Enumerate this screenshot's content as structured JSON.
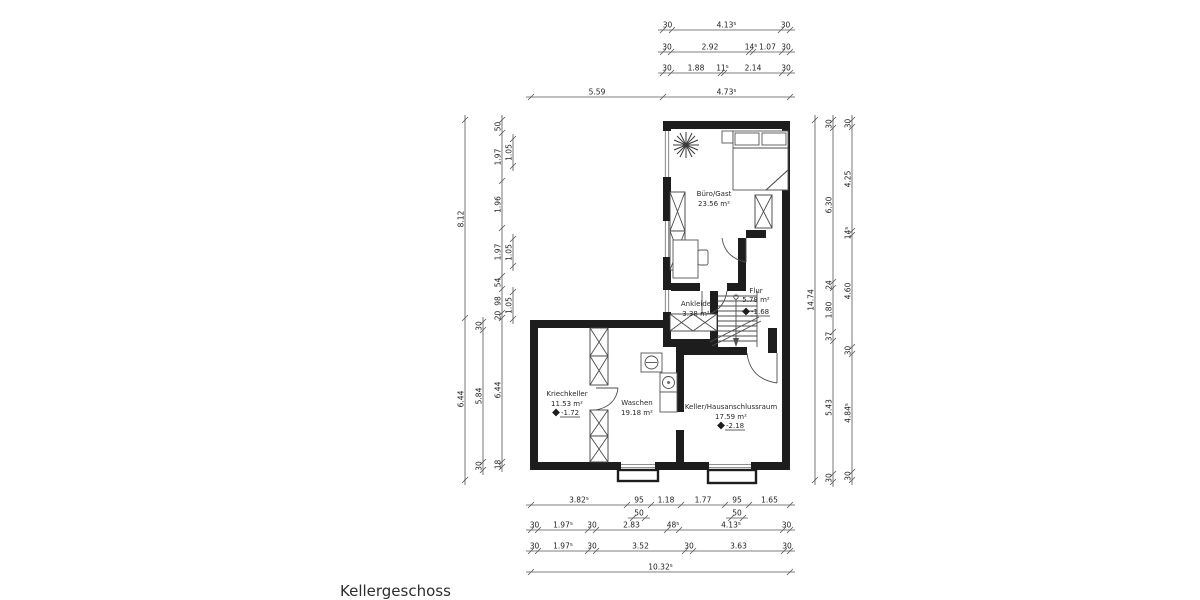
{
  "title": "Kellergeschoss",
  "rooms": {
    "buero": {
      "name": "Büro/Gast",
      "area": "23.56 m²"
    },
    "ankleide": {
      "name": "Ankleide",
      "area": "3.38 m²"
    },
    "flur": {
      "name": "Flur",
      "area": "5.78 m²",
      "level": "-1.68"
    },
    "kriechkeller": {
      "name": "Kriechkeller",
      "area": "11.53 m²",
      "level": "-1.72"
    },
    "waschen": {
      "name": "Waschen",
      "area": "19.18 m²"
    },
    "keller": {
      "name": "Keller/Hausanschlussraum",
      "area": "17.59 m²",
      "level": "-2.18"
    }
  },
  "colors": {
    "wall": "#1d1d1d",
    "dim_line": "#555555",
    "dim_text": "#222222"
  },
  "dim_chains": [
    {
      "id": "top-1",
      "orient": "h",
      "pos": 30,
      "ticks": [
        663,
        672,
        781,
        790
      ],
      "labels": [
        "30",
        "4.13⁵",
        "30"
      ]
    },
    {
      "id": "top-2",
      "orient": "h",
      "pos": 52,
      "ticks": [
        663,
        671,
        749,
        753,
        782,
        790
      ],
      "labels": [
        "30",
        "2.92",
        "14⁵",
        "1.07",
        "30"
      ]
    },
    {
      "id": "top-3",
      "orient": "h",
      "pos": 73,
      "ticks": [
        663,
        671,
        721,
        724,
        782,
        790
      ],
      "labels": [
        "30",
        "1.88",
        "11⁵",
        "2.14",
        "30"
      ]
    },
    {
      "id": "top-4",
      "orient": "h",
      "pos": 97,
      "ticks": [
        531,
        663,
        790
      ],
      "labels": [
        "5.59",
        "4.73⁵"
      ]
    },
    {
      "id": "left-1",
      "orient": "v",
      "pos": 465,
      "ticks": [
        120,
        318,
        480
      ],
      "labels": [
        "8.12",
        "6.44"
      ]
    },
    {
      "id": "left-2",
      "orient": "v",
      "pos": 483,
      "ticks": [
        322,
        330,
        462,
        470
      ],
      "labels": [
        "30",
        "5.84",
        "30"
      ]
    },
    {
      "id": "left-3",
      "orient": "v",
      "pos": 502,
      "ticks": [
        120,
        133,
        181,
        228,
        276,
        289,
        313,
        318,
        462,
        467
      ],
      "labels": [
        "50",
        "1.97",
        "1.96",
        "1.97",
        "54",
        "98",
        "20",
        "6.44",
        "18"
      ]
    },
    {
      "id": "left-3b",
      "orient": "v",
      "pos": 513,
      "ticks": [
        139,
        166
      ],
      "labels": [
        "1.05"
      ]
    },
    {
      "id": "left-3c",
      "orient": "v",
      "pos": 513,
      "ticks": [
        239,
        266
      ],
      "labels": [
        "1.05"
      ]
    },
    {
      "id": "left-3d",
      "orient": "v",
      "pos": 513,
      "ticks": [
        292,
        319
      ],
      "labels": [
        "1.05"
      ]
    },
    {
      "id": "right-1",
      "orient": "v",
      "pos": 815,
      "ticks": [
        120,
        480
      ],
      "labels": [
        "14.74"
      ]
    },
    {
      "id": "right-2",
      "orient": "v",
      "pos": 833,
      "ticks": [
        120,
        128,
        282,
        288,
        332,
        341,
        474,
        482
      ],
      "labels": [
        "30",
        "6.30",
        "24",
        "1.80",
        "37",
        "5.43",
        "30"
      ]
    },
    {
      "id": "right-3",
      "orient": "v",
      "pos": 852,
      "ticks": [
        120,
        127,
        231,
        235,
        347,
        354,
        472,
        480
      ],
      "labels": [
        "30",
        "4.25",
        "14⁵",
        "4.60",
        "30",
        "4.84⁵",
        "30"
      ]
    },
    {
      "id": "bot-1",
      "orient": "h",
      "pos": 505,
      "ticks": [
        531,
        627,
        651,
        681,
        725,
        749,
        790
      ],
      "labels": [
        "3.82⁵",
        "95",
        "1.18",
        "1.77",
        "95",
        "1.65"
      ]
    },
    {
      "id": "bot-1b",
      "orient": "h",
      "pos": 518,
      "ticks": [
        633,
        645
      ],
      "labels": [
        "50"
      ]
    },
    {
      "id": "bot-1c",
      "orient": "h",
      "pos": 518,
      "ticks": [
        731,
        743
      ],
      "labels": [
        "50"
      ]
    },
    {
      "id": "bot-2",
      "orient": "h",
      "pos": 530,
      "ticks": [
        531,
        538,
        588,
        596,
        667,
        679,
        783,
        790
      ],
      "labels": [
        "30",
        "1.97⁵",
        "30",
        "2.83",
        "48⁵",
        "4.13⁵",
        "30"
      ]
    },
    {
      "id": "bot-3",
      "orient": "h",
      "pos": 551,
      "ticks": [
        531,
        538,
        588,
        596,
        685,
        693,
        784,
        790
      ],
      "labels": [
        "30",
        "1.97⁵",
        "30",
        "3.52",
        "30",
        "3.63",
        "30"
      ]
    },
    {
      "id": "bot-4",
      "orient": "h",
      "pos": 572,
      "ticks": [
        531,
        790
      ],
      "labels": [
        "10.32⁵"
      ]
    }
  ]
}
